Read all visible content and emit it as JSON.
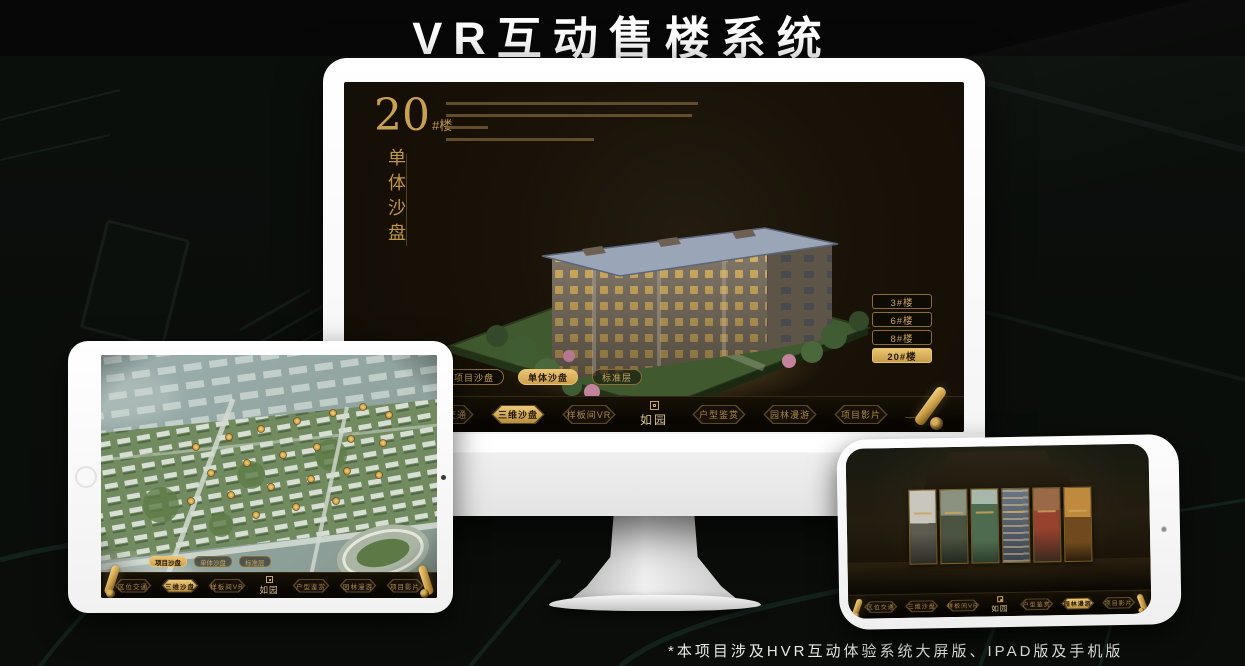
{
  "page": {
    "title": "VR互动售楼系统",
    "footnote": "*本项目涉及HVR互动体验系统大屏版、IPAD版及手机版"
  },
  "colors": {
    "gold": "#c49a4e",
    "gold_bright": "#eac474",
    "screen_bg": "#181209",
    "navbar_bg": "#0b0803"
  },
  "monitor_app": {
    "headline_number": "20",
    "headline_suffix": "#楼",
    "headline_vertical": "单体沙盘",
    "floor_buttons": [
      {
        "label": "3#楼",
        "active": false
      },
      {
        "label": "6#楼",
        "active": false
      },
      {
        "label": "8#楼",
        "active": false
      },
      {
        "label": "20#楼",
        "active": true
      }
    ],
    "sub_tabs": [
      {
        "label": "项目沙盘",
        "active": false
      },
      {
        "label": "单体沙盘",
        "active": true
      },
      {
        "label": "标准层",
        "active": false
      }
    ],
    "logo": "如园",
    "nav_items": [
      {
        "label": "区位交通",
        "active": false
      },
      {
        "label": "三维沙盘",
        "active": true
      },
      {
        "label": "样板间VR",
        "active": false
      },
      {
        "label": "户型鉴赏",
        "active": false
      },
      {
        "label": "园林漫游",
        "active": false
      },
      {
        "label": "项目影片",
        "active": false
      }
    ]
  },
  "tablet_app": {
    "sub_tabs": [
      {
        "label": "项目沙盘",
        "active": true
      },
      {
        "label": "单体沙盘",
        "active": false
      },
      {
        "label": "标准层",
        "active": false
      }
    ],
    "logo": "如园",
    "nav_items": [
      {
        "label": "区位交通",
        "active": false
      },
      {
        "label": "三维沙盘",
        "active": true
      },
      {
        "label": "样板间VR",
        "active": false
      },
      {
        "label": "户型鉴赏",
        "active": false
      },
      {
        "label": "园林漫游",
        "active": false
      },
      {
        "label": "项目影片",
        "active": false
      }
    ]
  },
  "phone_app": {
    "logo": "如园",
    "nav_items": [
      {
        "label": "区位交通",
        "active": false
      },
      {
        "label": "三维沙盘",
        "active": false
      },
      {
        "label": "样板间VR",
        "active": false
      },
      {
        "label": "户型鉴赏",
        "active": false
      },
      {
        "label": "园林漫游",
        "active": true
      },
      {
        "label": "项目影片",
        "active": false
      }
    ]
  }
}
